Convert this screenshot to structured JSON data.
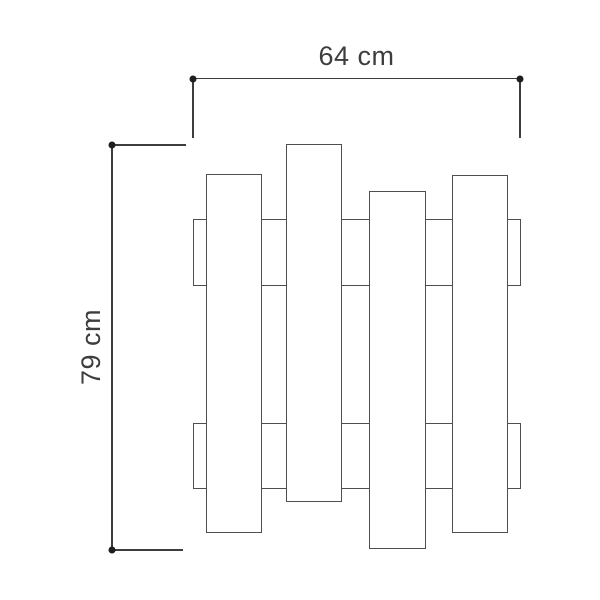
{
  "diagram": {
    "dimensions": {
      "width": {
        "label": "64 cm"
      },
      "height": {
        "label": "79 cm"
      }
    },
    "colors": {
      "background": "#ffffff",
      "line": "#4f4f4f",
      "dimension_line": "#3d3d3d",
      "dot": "#1f1f1f",
      "text": "#3d3d3d"
    },
    "figure": {
      "description": "front view of slatted wall coat rack: four staggered vertical planks over two horizontal rails",
      "parts": [
        {
          "name": "top-rail",
          "x": 193,
          "y": 219,
          "w": 328,
          "h": 67
        },
        {
          "name": "bottom-rail",
          "x": 193,
          "y": 423,
          "w": 328,
          "h": 66
        },
        {
          "name": "plank-1",
          "x": 206,
          "y": 174,
          "w": 56,
          "h": 359
        },
        {
          "name": "plank-2",
          "x": 286,
          "y": 144,
          "w": 56,
          "h": 358
        },
        {
          "name": "plank-3",
          "x": 369,
          "y": 191,
          "w": 57,
          "h": 358
        },
        {
          "name": "plank-4",
          "x": 452,
          "y": 175,
          "w": 56,
          "h": 358
        }
      ]
    }
  }
}
